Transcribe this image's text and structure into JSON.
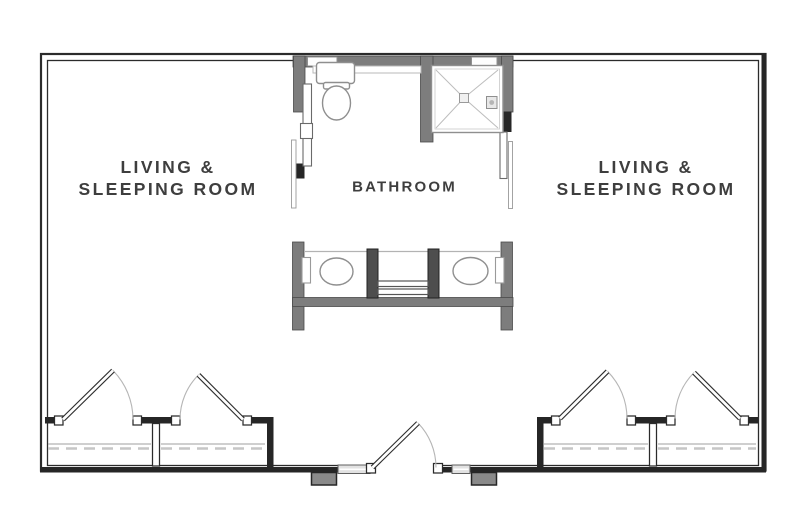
{
  "meta": {
    "title": "Floor Plan"
  },
  "colors": {
    "background": "#ffffff",
    "wall_line": "#2b2b2b",
    "wall_dark": "#262626",
    "wall_gray": "#7d7d7d",
    "stub_dark": "#4e4e4e",
    "fixture_line": "#8f8f8f",
    "light_line": "#b5b5b5",
    "window_fill": "#e2e2e2",
    "step_fill": "#8a8a8a",
    "text": "#3e3e3e"
  },
  "rooms": {
    "left": {
      "line1": "LIVING &",
      "line2": "SLEEPING ROOM"
    },
    "right": {
      "line1": "LIVING &",
      "line2": "SLEEPING ROOM"
    },
    "bathroom": {
      "label": "BATHROOM"
    }
  },
  "symbols": {
    "fixtures": [
      "toilet",
      "corner-shower",
      "vanity-sink",
      "vanity-sink"
    ],
    "doors": [
      "closet-door",
      "closet-door",
      "closet-door",
      "closet-door",
      "entry-door",
      "sliding-door",
      "sliding-door"
    ],
    "windows": [
      "bathroom-window",
      "bathroom-window",
      "entry-sidelight",
      "entry-sidelight"
    ],
    "storage": [
      "wardrobe-closet",
      "wardrobe-closet",
      "wardrobe-closet",
      "wardrobe-closet"
    ],
    "exterior": [
      "entry-step",
      "entry-step"
    ]
  }
}
